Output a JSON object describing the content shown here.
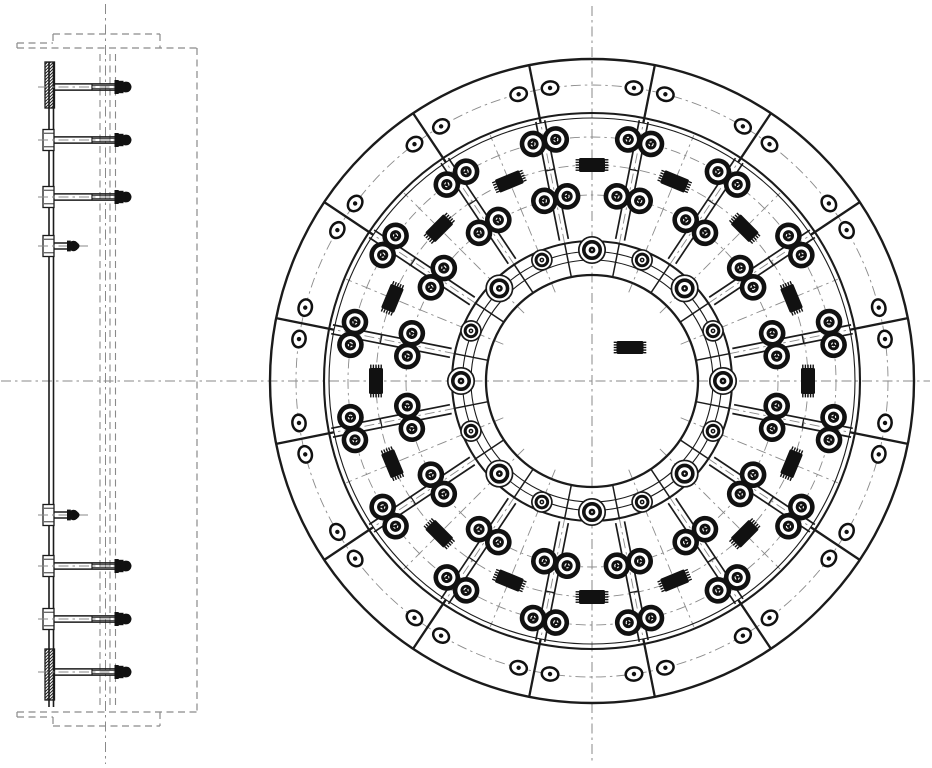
{
  "drawing": {
    "kind": "mechanical-assembly-drawing",
    "canvas": {
      "width": 932,
      "height": 768
    },
    "style": {
      "bg": "#ffffff",
      "line": "#1b1b1b",
      "thin": "#3c3c3c",
      "fill": "#111111",
      "center": "#8a8a8a",
      "phantom": "#8a8a8a",
      "dash_center": "10,4,2.5,4",
      "dash_phantom": "7,4.5"
    }
  },
  "front_view": {
    "center": {
      "x": 592,
      "y": 381
    },
    "sectors": 16,
    "sector_step_deg": 22.5,
    "arm_offset_deg": 11.25,
    "rim_oval_offset_deg": 3.1,
    "radii": {
      "outer": 322,
      "rim_inner_heavy": 268,
      "rim_inner_thin": 263,
      "rim_bolt_circle": 296,
      "arm_outer_bolts": 244,
      "pad_center": 216,
      "arm_inner_bolts": 186,
      "hub_outer": 140,
      "hub_band_a": 129.5,
      "hub_band_b": 121,
      "hub_bolt_circle": 131,
      "bore": 106,
      "pad_dashline_inner": 96,
      "pad_dashline_outer": 266,
      "arm_dashline_outer": 321
    },
    "dash_circles": [
      186,
      216,
      244,
      296
    ],
    "arm": {
      "half_width": 4.5,
      "inner_r": 144,
      "outer_r": 265,
      "bolt_tangential_offset": 11.6,
      "mid_tick_r": 215,
      "bolt": {
        "outer_r": 11,
        "ring_w": 4.6,
        "disc_r": 5.6,
        "core_r": 2.1
      }
    },
    "pad": {
      "length": 26,
      "width": 14,
      "tooth_len": 3.4,
      "tooth_gap": 2.6,
      "teeth": 5
    },
    "rim_oval": {
      "rx": 8.3,
      "ry": 6.6,
      "ring_w": 2.5,
      "core_r": 2.2
    },
    "hub_bolt_large": {
      "outer_r": 13.2,
      "ring_r": 8.2,
      "ring_w": 3.6,
      "core_r": 3.4
    },
    "hub_bolt_small": {
      "outer_r": 10,
      "ring_r": 5.8,
      "ring_w": 3.0,
      "core_r": 2.4
    },
    "center_mark": {
      "x": 630,
      "y": 347.5,
      "length": 27,
      "width": 13
    },
    "centerlines": {
      "h": [
        2,
        930
      ],
      "v": [
        6,
        762
      ]
    }
  },
  "side_view": {
    "plate": {
      "x1": 49,
      "x2": 53.5,
      "top": 62,
      "bottom": 707
    },
    "hatch_blocks": [
      {
        "x": 45,
        "y": 62,
        "w": 9.5,
        "h": 46
      },
      {
        "x": 45,
        "y": 649,
        "w": 9.5,
        "h": 51
      }
    ],
    "studs": [
      {
        "y": 87,
        "type": "long"
      },
      {
        "y": 140,
        "type": "long"
      },
      {
        "y": 197,
        "type": "long"
      },
      {
        "y": 246,
        "type": "short"
      },
      {
        "y": 515,
        "type": "short"
      },
      {
        "y": 566,
        "type": "long"
      },
      {
        "y": 619,
        "type": "long"
      },
      {
        "y": 672,
        "type": "long"
      }
    ],
    "clip_rows": [
      140,
      197,
      246,
      515,
      566,
      619
    ],
    "long_stud": {
      "shaft_start": 54,
      "shaft_end": 114.5,
      "half": 3.1,
      "thread_x": 92,
      "axis_end": 134
    },
    "short_stud": {
      "shaft_start": 54,
      "shaft_end": 67,
      "half": 3.0,
      "axis_end": 88
    },
    "axis_start": 38,
    "phantom_segments": [
      [
        53,
        34,
        160,
        34
      ],
      [
        17,
        43,
        53,
        43
      ],
      [
        53,
        34,
        53,
        43
      ],
      [
        17,
        43,
        17,
        48
      ],
      [
        17,
        48,
        197,
        48
      ],
      [
        160,
        34,
        160,
        48
      ],
      [
        53,
        726,
        160,
        726
      ],
      [
        17,
        717,
        53,
        717
      ],
      [
        53,
        717,
        53,
        726
      ],
      [
        17,
        712,
        17,
        717
      ],
      [
        17,
        712,
        197,
        712
      ],
      [
        160,
        712,
        160,
        726
      ],
      [
        197,
        48,
        197,
        712
      ]
    ],
    "phantom_verticals": [
      [
        100,
        54,
        100,
        706
      ],
      [
        110,
        54,
        110,
        706
      ],
      [
        115.5,
        54,
        115.5,
        706
      ]
    ],
    "center_vertical": {
      "x": 105.5,
      "y1": 4,
      "y2": 764
    },
    "main_horizontal": {
      "y": 381,
      "x1": 1,
      "x2": 930
    }
  }
}
